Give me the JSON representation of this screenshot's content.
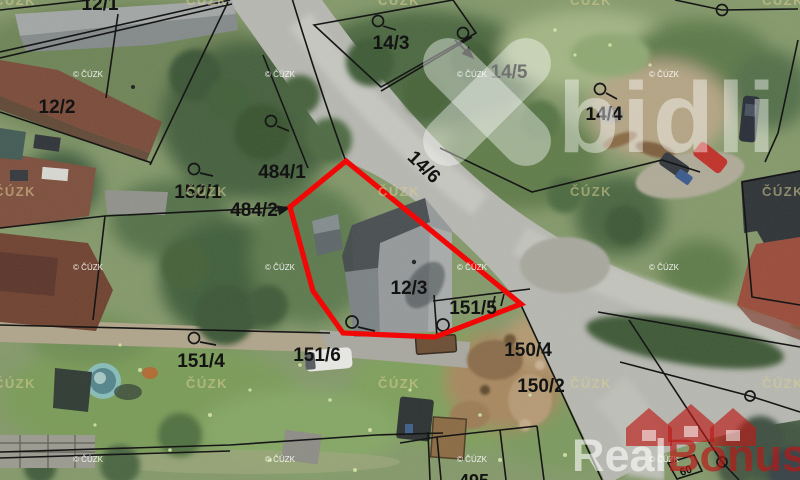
{
  "map_type": "cadastral-aerial-hybrid",
  "highlight_color": "#f20707",
  "boundary_color": "#161616",
  "parcel_labels": [
    {
      "text": "12/1"
    },
    {
      "text": "12/2"
    },
    {
      "text": "14/3"
    },
    {
      "text": "14/5"
    },
    {
      "text": "14/4"
    },
    {
      "text": "152/1"
    },
    {
      "text": "484/1"
    },
    {
      "text": "484/2"
    },
    {
      "text": "14/6"
    },
    {
      "text": "12/3"
    },
    {
      "text": "151/5"
    },
    {
      "text": "151/4"
    },
    {
      "text": "151/6"
    },
    {
      "text": "150/4"
    },
    {
      "text": "150/2"
    },
    {
      "text": "495"
    },
    {
      "text": "60"
    }
  ],
  "watermarks": {
    "brand_top": "bidli",
    "brand_bottom_white": "Real",
    "brand_bottom_red": "Bonus",
    "brand_bottom_suffix": "cz",
    "cuzk_small": "© ČÚZK",
    "cuzk_large": "ČÚZK"
  }
}
